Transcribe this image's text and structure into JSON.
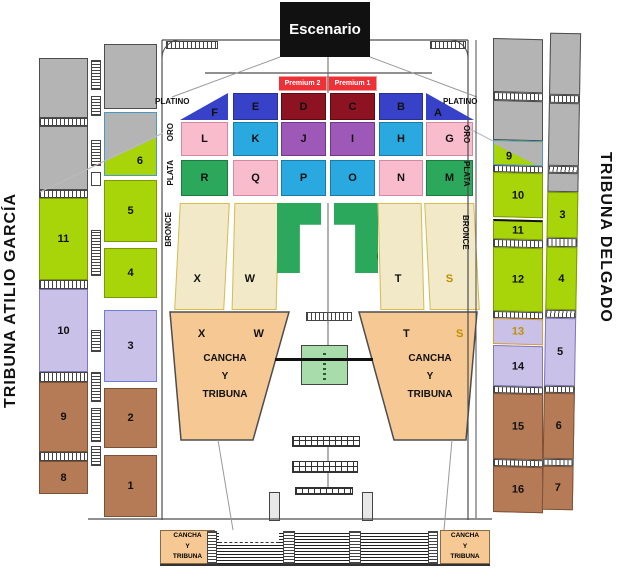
{
  "stage": {
    "label": "Escenario"
  },
  "premium": {
    "left": "Premium 2",
    "right": "Premium 1"
  },
  "tiers": {
    "platino": {
      "label": "PLATINO",
      "sections": [
        "F",
        "E",
        "D",
        "C",
        "B",
        "A"
      ]
    },
    "oro": {
      "label": "ORO",
      "sections": [
        "L",
        "K",
        "J",
        "I",
        "H",
        "G"
      ]
    },
    "plata": {
      "label": "PLATA",
      "sections": [
        "R",
        "Q",
        "P",
        "O",
        "N",
        "M"
      ]
    },
    "bronce": {
      "label": "BRONCE",
      "sections_top": [
        "X",
        "W",
        "V",
        "U",
        "T",
        "S"
      ],
      "sections_bottom": [
        "X",
        "W",
        "T",
        "S"
      ]
    }
  },
  "field": {
    "cancha_left": "CANCHA\nY\nTRIBUNA",
    "cancha_right": "CANCHA\nY\nTRIBUNA"
  },
  "bottom": {
    "cancha_left": "CANCHA\nY\nTRIBUNA",
    "cancha_right": "CANCHA\nY\nTRIBUNA"
  },
  "tribuna_left": {
    "title": "TRIBUNA ATILIO GARCÍA",
    "outer_sections": [
      "11",
      "10",
      "9",
      "8"
    ],
    "inner_sections": [
      "6",
      "5",
      "4",
      "3",
      "2",
      "1"
    ]
  },
  "tribuna_right": {
    "title": "TRIBUNA DELGADO",
    "inner_sections": [
      "9",
      "10",
      "11",
      "12",
      "13",
      "14",
      "15",
      "16"
    ],
    "outer_sections": [
      "3",
      "4",
      "5",
      "6",
      "7"
    ]
  },
  "colors": {
    "lime": "#a8d40a",
    "gray": "#b4b4b4",
    "lavender": "#c9c1e8",
    "brown": "#b57a56",
    "blue": "#3742c8",
    "dark_red": "#8e1322",
    "premium_red": "#ee3137",
    "cyan": "#2aa9e0",
    "purple": "#9d58b8",
    "pink": "#f8bccd",
    "green": "#2ca85c",
    "tan": "#f1e9c8",
    "field_peach": "#f6c894",
    "center_green": "#a8dcaa",
    "stage_black": "#111111",
    "gold_text": "#bf9000"
  }
}
